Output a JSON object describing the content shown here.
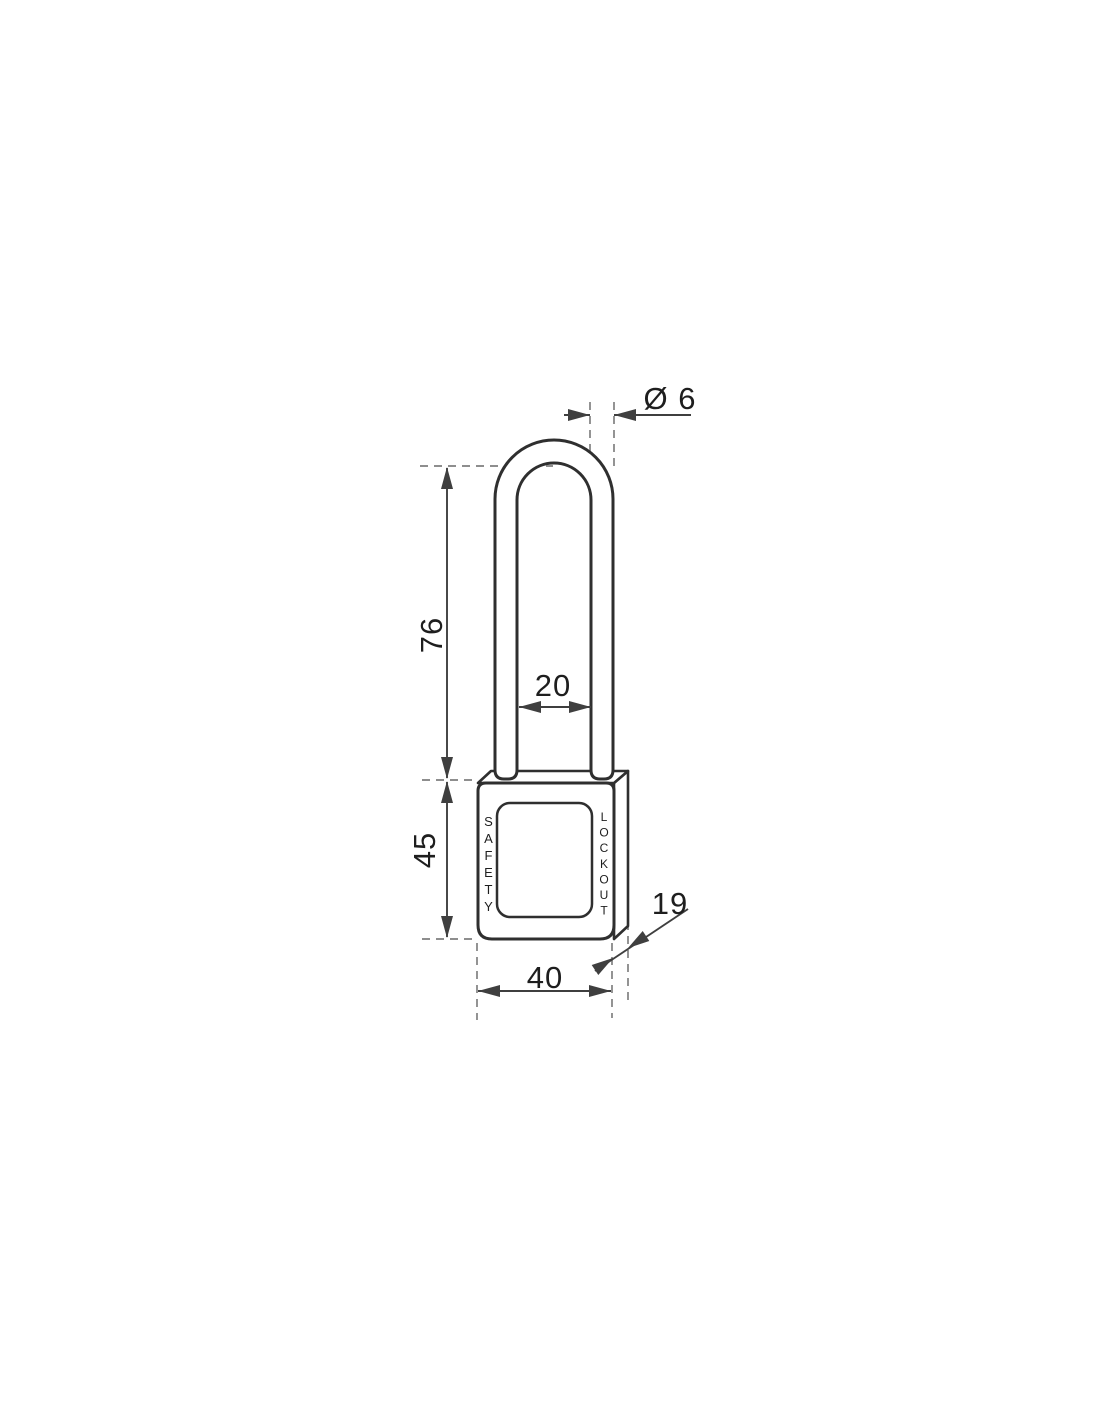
{
  "drawing": {
    "kind": "padlock-technical-drawing",
    "body_text": {
      "left_vertical": "SAFETY",
      "right_vertical": "LOCKOUT"
    },
    "dimensions": {
      "shackle_diameter": "Ø 6",
      "shackle_clearance_height": "76",
      "body_height": "45",
      "shackle_inner_width": "20",
      "body_width": "40",
      "body_depth": "19"
    },
    "colors": {
      "outline": "#2f2f2f",
      "dim": "#3f3f3f",
      "dash": "#8e8e8e",
      "ink": "#1e1e1e",
      "bg": "#ffffff"
    }
  }
}
